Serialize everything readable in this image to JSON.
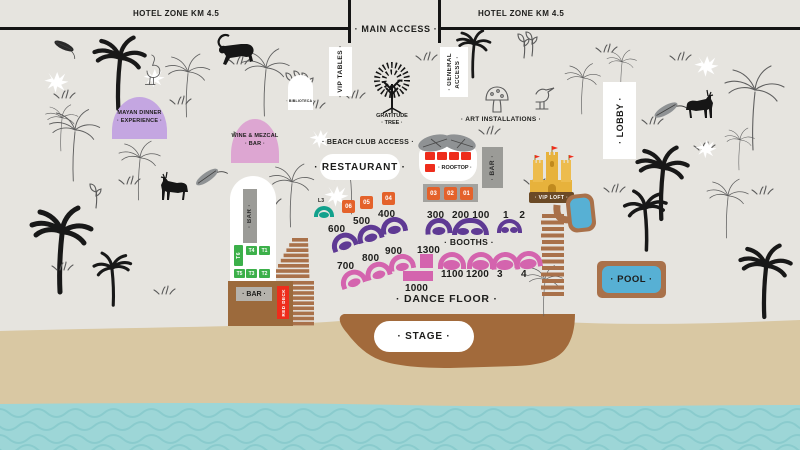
{
  "title": "Beach club festival site map",
  "colors": {
    "background": "#e6e4df",
    "sand": "#d9c8a3",
    "water": "#9dd6d7",
    "wood": "#a9714a",
    "purple": "#5f3a94",
    "pink": "#d464ae",
    "orange": "#e4622b",
    "teal": "#12a18c",
    "green": "#3cb04a",
    "red": "#ee2d1c",
    "mayan": "#c4a6e1",
    "wine": "#dda6d2",
    "pool_blue": "#57b0d4",
    "castle": "#e7b23c",
    "gray": "#9b9b97",
    "ink": "#1d1d1b"
  },
  "header": {
    "hotel_zone_left": "HOTEL ZONE KM 4.5",
    "hotel_zone_right": "HOTEL ZONE KM 4.5",
    "main_access": "· MAIN ACCESS ·"
  },
  "zones": {
    "vip_tables": "· VIP TABLES ·",
    "biblioteca": "· BIBLIOTECA ·",
    "general_access_l1": "· GENERAL",
    "general_access_l2": "ACCESS ·",
    "lobby": "· LOBBY ·",
    "mayan_l1": "MAYAN DINNER",
    "mayan_l2": "· EXPERIENCE ·",
    "wine_l1": "WINE & MEZCAL",
    "wine_l2": "· BAR ·",
    "beach_club_access": "· BEACH CLUB ACCESS ·",
    "restaurant": "· RESTAURANT ·",
    "gratitude_l1": "GRATITUDE",
    "gratitude_l2": "· TREE ·",
    "art_installations": "· ART INSTALLATIONS ·",
    "rooftop": "· ROOFTOP ·",
    "rooftop_bar": "· BAR ·",
    "vip_loft": "· VIP LOFT ·",
    "pool": "· POOL ·",
    "booths": "· BOOTHS ·",
    "dance_floor": "· DANCE FLOOR ·",
    "stage": "· STAGE ·",
    "oval_bar": "· BAR ·",
    "deck_bar": "· BAR ·",
    "red_deck": "RED DECK"
  },
  "booths": {
    "orange": [
      "06",
      "05",
      "04",
      "03",
      "02",
      "01"
    ],
    "purple": [
      "600",
      "500",
      "400",
      "300",
      "200 100",
      "1 2"
    ],
    "pink": [
      "700",
      "800",
      "900",
      "1300",
      "1000",
      "1100",
      "1200",
      "3",
      "4"
    ],
    "teal": "L3",
    "green": [
      "T6",
      "T4",
      "T1",
      "T5",
      "T3",
      "T2"
    ]
  }
}
